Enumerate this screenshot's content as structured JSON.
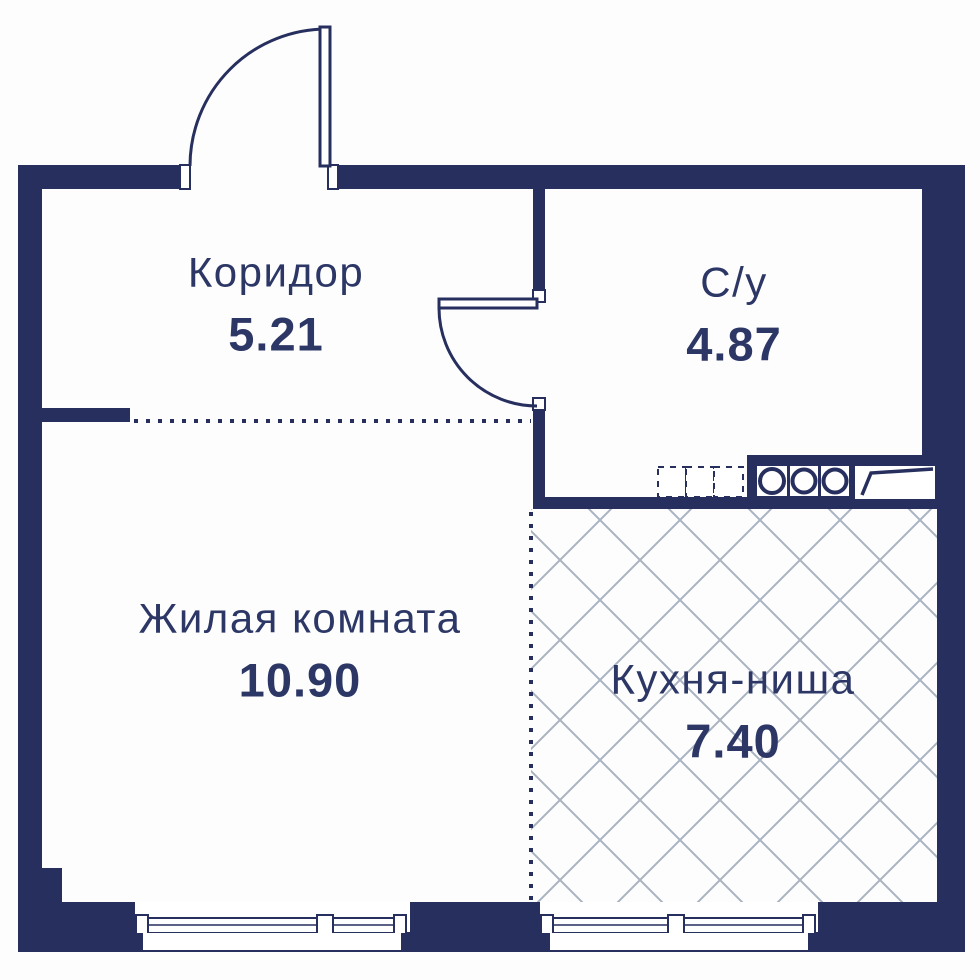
{
  "rooms": {
    "corridor": {
      "name": "Коридор",
      "area": "5.21"
    },
    "bathroom": {
      "name": "С/у",
      "area": "4.87"
    },
    "living_room": {
      "name": "Жилая комната",
      "area": "10.90"
    },
    "kitchen_niche": {
      "name": "Кухня-ниша",
      "area": "7.40"
    }
  },
  "fixtures": {
    "stove_burners": 3,
    "entrance_door": "swing-out-top-wall",
    "bathroom_door": "swing-into-corridor",
    "windows": 2
  },
  "colors": {
    "wall": "#272f5e",
    "text": "#2c3766",
    "hatch": "#a9b2c0",
    "background": "#ffffff"
  }
}
